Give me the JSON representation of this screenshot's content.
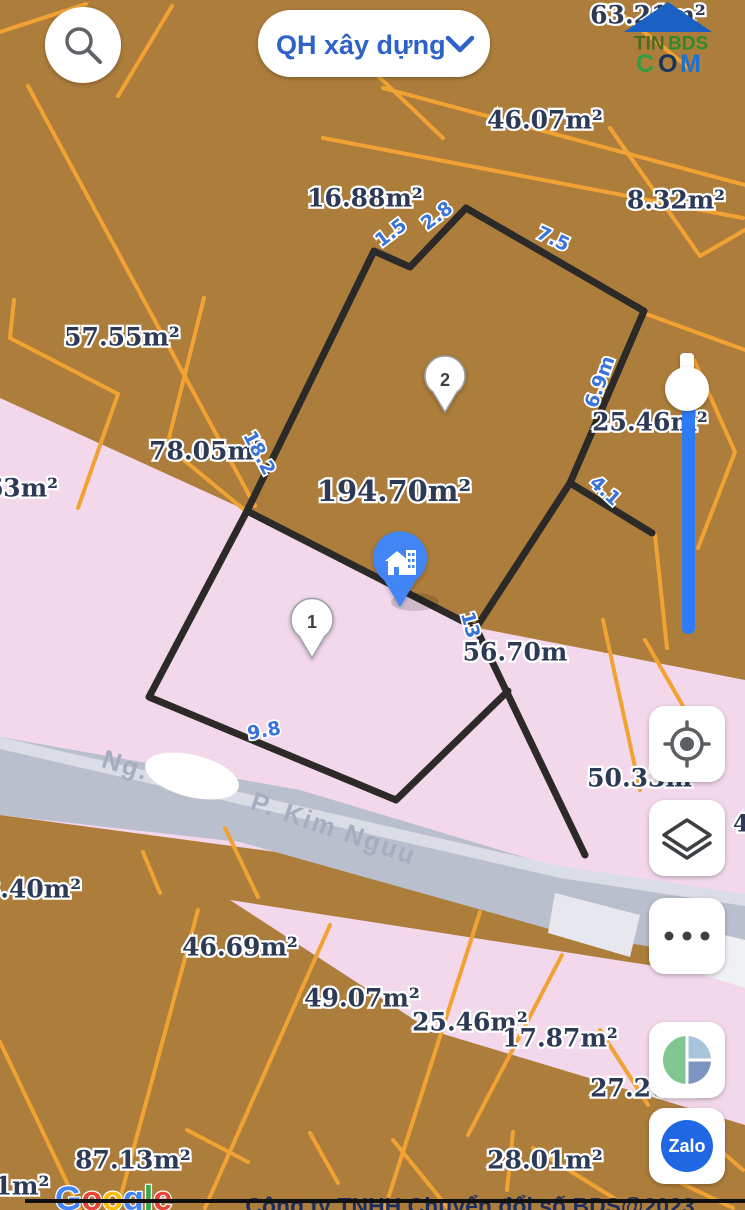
{
  "header": {
    "search_icon": "magnifier-icon",
    "layer_selector": {
      "label": "QH xây dựng",
      "chevron": "v"
    },
    "logo": {
      "roof": "blue-house-roof",
      "tin": "TIN",
      "bds": "BDS",
      "c": "C",
      "o": "O",
      "m": "M"
    }
  },
  "map": {
    "area_labels": [
      "63.21m²",
      "46.07m²",
      "16.88m²",
      "8.32m²",
      "57.55m²",
      "78.05m²",
      "63m²",
      "25.46m²",
      "194.70m²",
      "56.70m",
      "50.33m²",
      "8.40m²",
      "46.69m²",
      "49.07m²",
      "25.46m²",
      "17.87m²",
      "27.20m²",
      "87.13m²",
      "28.01m²",
      "1m²",
      "4"
    ],
    "dimension_labels": [
      "1.5",
      "2.8",
      "7.5",
      "18.2",
      "6.9m",
      "4.1",
      "13",
      "9.8"
    ],
    "street": {
      "prefix": "Ng.",
      "suffix": "P. Kim Nguu"
    },
    "markers": [
      {
        "id": "1"
      },
      {
        "id": "2"
      }
    ],
    "selected_marker": "house-building-pin",
    "colors": {
      "parcel_brown": "#ad7d3b",
      "parcel_pink": "#f3d8ec",
      "cadastral_line_orange": "#f2a233",
      "highlight_outline_black": "#2b2a28",
      "road_gray": "#b9bfcc",
      "dimension_blue": "#3b74d8",
      "area_label_navy": "#2d3a56",
      "slider_blue": "#2e7bf6"
    }
  },
  "controls": {
    "locate": "my-location",
    "layers": "map-layers",
    "more": "more-options",
    "maptype": "map-type-toggle",
    "zalo_label": "Zalo"
  },
  "footer": {
    "google_letters": [
      "G",
      "o",
      "o",
      "g",
      "l",
      "e"
    ],
    "copyright": "Công ty TNHH Chuyển đổi số BDS@2023"
  }
}
